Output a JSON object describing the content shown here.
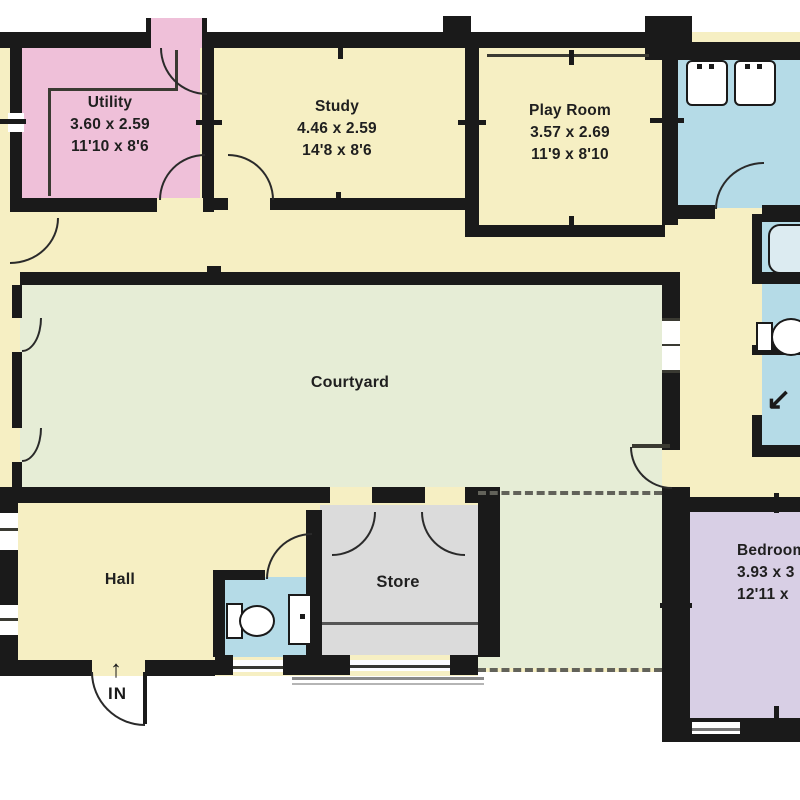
{
  "plan": {
    "type": "floorplan",
    "entry": {
      "arrow": "↑",
      "label": "IN"
    },
    "shower_arrow": "↙",
    "rooms": [
      {
        "id": "utility",
        "name": "Utility",
        "dim_m": "3.60 x 2.59",
        "dim_ft": "11'10 x 8'6"
      },
      {
        "id": "study",
        "name": "Study",
        "dim_m": "4.46 x 2.59",
        "dim_ft": "14'8 x 8'6"
      },
      {
        "id": "playroom",
        "name": "Play Room",
        "dim_m": "3.57 x 2.69",
        "dim_ft": "11'9 x 8'10"
      },
      {
        "id": "courtyard",
        "name": "Courtyard",
        "dim_m": "",
        "dim_ft": ""
      },
      {
        "id": "hall",
        "name": "Hall",
        "dim_m": "",
        "dim_ft": ""
      },
      {
        "id": "store",
        "name": "Store",
        "dim_m": "",
        "dim_ft": ""
      },
      {
        "id": "bedroom",
        "name": "Bedroom",
        "dim_m": "3.93 x 3",
        "dim_ft": "12'11 x"
      }
    ],
    "colors": {
      "cream": "#f6efc3",
      "pink": "#efc0d9",
      "green": "#e6edd6",
      "blue": "#b5dbe7",
      "purple": "#d8cfe5",
      "gray": "#dbdbdb",
      "wall": "#1a1a1a"
    }
  }
}
